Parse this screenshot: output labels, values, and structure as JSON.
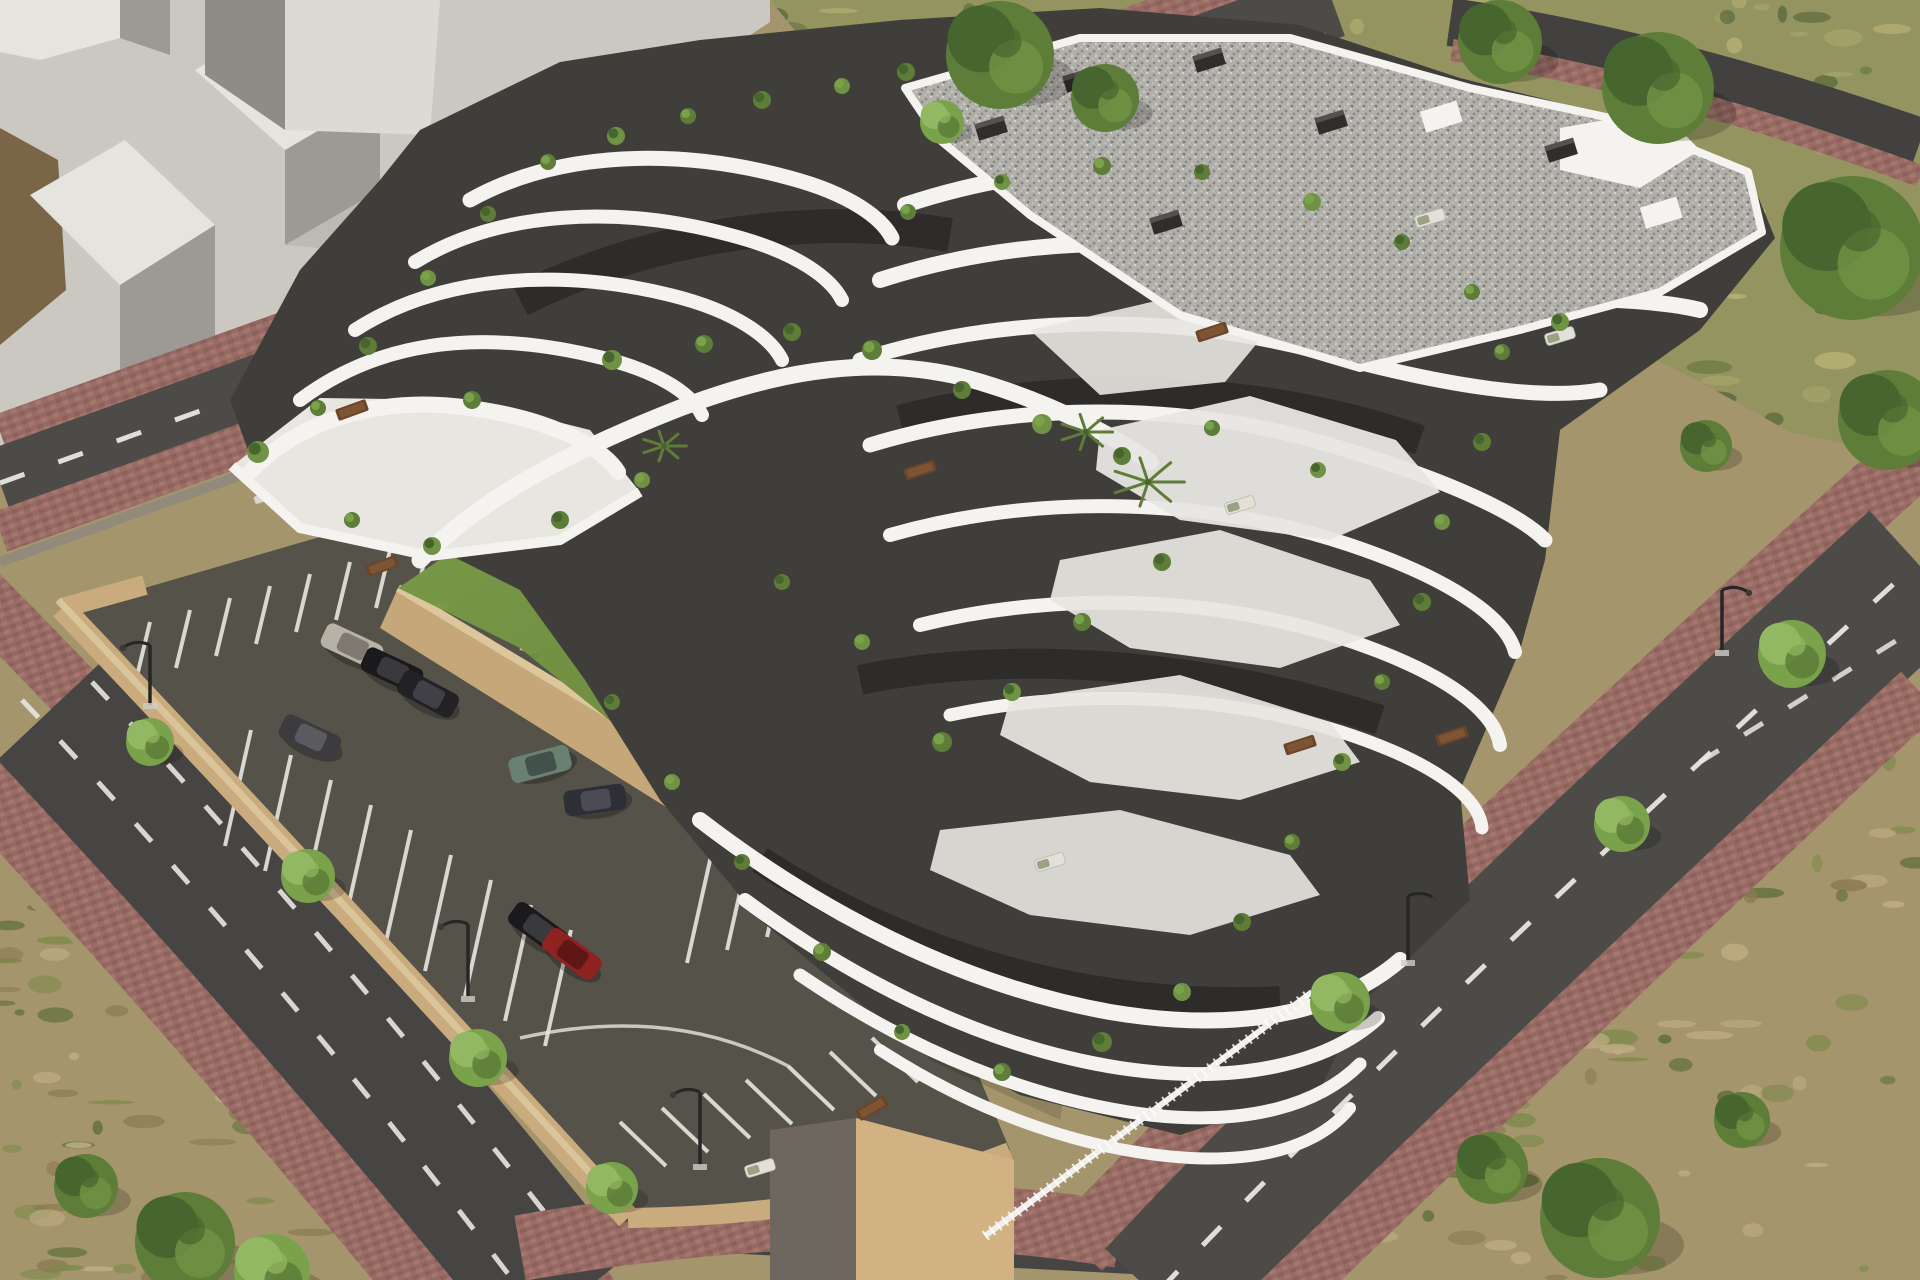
{
  "scene": {
    "kind": "architectural-aerial-render",
    "width": 1920,
    "height": 1280,
    "subject": "terraced-apartment-complex-with-pool-courtyard-parking-and-ring-roads"
  },
  "palette": {
    "massing-base": "#cbc8c2",
    "massing-light": "#e6e4df",
    "massing-top": "#dcdad5",
    "massing-dark": "#9d9a95",
    "massing-shadow": "#b2afaa",
    "ground-brown": "#7a6647",
    "drygrass": "#949461",
    "drygrass-l1": "#b7b173",
    "drygrass-l2": "#a3a368",
    "drygrass-d1": "#66763f",
    "drygrass-d2": "#55653a",
    "scrub": "#a5956d",
    "scrub-g1": "#5c6e38",
    "scrub-g2": "#7b8a49",
    "scrub-l1": "#c0ae85",
    "road": "#4c4b48",
    "road-dark": "#424140",
    "brick": "#996d66",
    "brick-a": "#8d605a",
    "brick-b": "#a5776f",
    "brick-c": "#936760",
    "curb": "#8a8782",
    "parking-asphalt": "#555249",
    "parking-dark": "#494640",
    "wall-top": "#dcc79c",
    "wall-face": "#c5a77a",
    "wall-dark": "#a8895f",
    "lawn": "#6e8e3e",
    "lawn-light": "#7d9c49",
    "lawn-dark": "#5e7b34",
    "pool-light": "#d3ece7",
    "pool-deep": "#9fd6cc",
    "coping": "#f7f6f3",
    "deck": "#8d887a",
    "deck-dark": "#5f5c51",
    "bldg-white": "#f4f3ef",
    "bldg-terrace": "#e8e6e1",
    "bldg-shade": "#d8d6d0",
    "bldg-dark": "#403e3a",
    "bldg-glass": "#2d2c2a",
    "bldg-mid": "#6e6b65",
    "plinth": "#d2b283",
    "gravel": "#b0afaa",
    "gravel-d": "#84837e",
    "gravel-l": "#d6d5d1",
    "green-bright": "#7aa24b",
    "green-mid": "#5d7d38",
    "green-dark": "#47662f",
    "green-light": "#93b863",
    "umbrella-tan": "#d2bb97",
    "umbrella-white": "#efedec",
    "lamp": "#262625",
    "stripe-white": "#e8e6e0",
    "playground-blue": "#3f5fc0",
    "playground-red": "#b04a3e",
    "playground-green": "#4a7b44",
    "table-brown": "#6b452a"
  },
  "parking": {
    "stripe_rows": [
      {
        "x": 150,
        "y": 622,
        "dx": 40,
        "dy": -12,
        "n": 12,
        "ex": -14,
        "ey": 58,
        "note": "row-under-top-road"
      },
      {
        "x": 238,
        "y": 788,
        "dx": 40,
        "dy": 25,
        "n": 9,
        "ex": 13,
        "ey": -58,
        "note": "middle-row-upper-side"
      },
      {
        "x": 238,
        "y": 788,
        "dx": 40,
        "dy": 25,
        "n": 9,
        "ex": -13,
        "ey": 58,
        "note": "middle-row-lower-side"
      },
      {
        "x": 700,
        "y": 905,
        "dx": 40,
        "dy": -13,
        "n": 8,
        "ex": 13,
        "ey": -58,
        "note": "east-row-upper-side"
      },
      {
        "x": 700,
        "y": 905,
        "dx": 40,
        "dy": -13,
        "n": 8,
        "ex": -13,
        "ey": 58,
        "note": "east-row-lower-side"
      },
      {
        "x": 620,
        "y": 1122,
        "dx": 42,
        "dy": -14,
        "n": 10,
        "ex": 46,
        "ey": 44,
        "note": "row-along-south-road"
      }
    ],
    "guide_arcs": [
      "M520,648 q66,18 78,96",
      "M560,700 q52,16 62,78",
      "M520,1038 q150,-34 268,28"
    ],
    "cars": [
      {
        "x": 352,
        "y": 646,
        "rot": 25,
        "body": "#b7b2a6",
        "glass": "#7e7a72",
        "name": "silver-car"
      },
      {
        "x": 392,
        "y": 670,
        "rot": 25,
        "body": "#1a1a1d",
        "glass": "#3a3a3e",
        "name": "black-car"
      },
      {
        "x": 428,
        "y": 694,
        "rot": 28,
        "body": "#222226",
        "glass": "#404046",
        "name": "black-car"
      },
      {
        "x": 310,
        "y": 737,
        "rot": 25,
        "body": "#3c3c40",
        "glass": "#5a5a60",
        "name": "gray-car"
      },
      {
        "x": 540,
        "y": 764,
        "rot": -15,
        "body": "#6a8071",
        "glass": "#42514a",
        "name": "green-suv"
      },
      {
        "x": 595,
        "y": 800,
        "rot": -8,
        "body": "#2e2e35",
        "glass": "#4b4b55",
        "name": "dark-sedan"
      },
      {
        "x": 538,
        "y": 928,
        "rot": 36,
        "body": "#1a1a1d",
        "glass": "#3a3a3e",
        "name": "black-car"
      },
      {
        "x": 572,
        "y": 954,
        "rot": 36,
        "body": "#8f2321",
        "glass": "#5e1715",
        "name": "red-car"
      }
    ]
  },
  "street": {
    "lamps": [
      {
        "x": 468,
        "y": 998,
        "h": 74,
        "dir": -1
      },
      {
        "x": 700,
        "y": 1166,
        "h": 74,
        "dir": -1
      },
      {
        "x": 1408,
        "y": 962,
        "h": 66,
        "dir": 1
      },
      {
        "x": 1722,
        "y": 652,
        "h": 62,
        "dir": 1
      },
      {
        "x": 150,
        "y": 705,
        "h": 60,
        "dir": -1
      }
    ]
  },
  "vegetation": {
    "trees": [
      {
        "x": 150,
        "y": 742,
        "r": 24,
        "t": "bright"
      },
      {
        "x": 308,
        "y": 876,
        "r": 27,
        "t": "bright"
      },
      {
        "x": 478,
        "y": 1058,
        "r": 29,
        "t": "bright"
      },
      {
        "x": 612,
        "y": 1188,
        "r": 26,
        "t": "bright"
      },
      {
        "x": 1340,
        "y": 1002,
        "r": 30,
        "t": "bright"
      },
      {
        "x": 1622,
        "y": 824,
        "r": 28,
        "t": "bright"
      },
      {
        "x": 1792,
        "y": 654,
        "r": 34,
        "t": "bright"
      },
      {
        "x": 1000,
        "y": 55,
        "r": 54,
        "t": "dark"
      },
      {
        "x": 1105,
        "y": 98,
        "r": 34,
        "t": "dark"
      },
      {
        "x": 942,
        "y": 122,
        "r": 22,
        "t": "bright"
      },
      {
        "x": 1500,
        "y": 42,
        "r": 42,
        "t": "dark"
      },
      {
        "x": 1658,
        "y": 88,
        "r": 56,
        "t": "dark"
      },
      {
        "x": 1852,
        "y": 248,
        "r": 72,
        "t": "dark"
      },
      {
        "x": 1888,
        "y": 420,
        "r": 50,
        "t": "dark"
      },
      {
        "x": 1706,
        "y": 446,
        "r": 26,
        "t": "dark"
      },
      {
        "x": 185,
        "y": 1242,
        "r": 50,
        "t": "dark"
      },
      {
        "x": 86,
        "y": 1186,
        "r": 32,
        "t": "dark"
      },
      {
        "x": 272,
        "y": 1272,
        "r": 38,
        "t": "bright"
      },
      {
        "x": 1600,
        "y": 1218,
        "r": 60,
        "t": "dark"
      },
      {
        "x": 1492,
        "y": 1168,
        "r": 36,
        "t": "dark"
      },
      {
        "x": 1742,
        "y": 1120,
        "r": 28,
        "t": "dark"
      }
    ],
    "palms": [
      {
        "x": 1148,
        "y": 482,
        "r": 26
      },
      {
        "x": 1086,
        "y": 432,
        "r": 19
      },
      {
        "x": 664,
        "y": 446,
        "r": 16
      }
    ],
    "terrace_plants": [
      {
        "x": 258,
        "y": 452,
        "r": 11
      },
      {
        "x": 318,
        "y": 408,
        "r": 8
      },
      {
        "x": 368,
        "y": 346,
        "r": 9
      },
      {
        "x": 428,
        "y": 278,
        "r": 8
      },
      {
        "x": 488,
        "y": 214,
        "r": 8
      },
      {
        "x": 548,
        "y": 162,
        "r": 8
      },
      {
        "x": 616,
        "y": 136,
        "r": 9
      },
      {
        "x": 688,
        "y": 116,
        "r": 8
      },
      {
        "x": 762,
        "y": 100,
        "r": 9
      },
      {
        "x": 842,
        "y": 86,
        "r": 8
      },
      {
        "x": 906,
        "y": 72,
        "r": 9
      },
      {
        "x": 472,
        "y": 400,
        "r": 9
      },
      {
        "x": 612,
        "y": 360,
        "r": 10
      },
      {
        "x": 704,
        "y": 344,
        "r": 9
      },
      {
        "x": 792,
        "y": 332,
        "r": 9
      },
      {
        "x": 642,
        "y": 480,
        "r": 8
      },
      {
        "x": 560,
        "y": 520,
        "r": 9
      },
      {
        "x": 352,
        "y": 520,
        "r": 8
      },
      {
        "x": 432,
        "y": 546,
        "r": 9
      },
      {
        "x": 872,
        "y": 350,
        "r": 10
      },
      {
        "x": 962,
        "y": 390,
        "r": 9
      },
      {
        "x": 1042,
        "y": 424,
        "r": 10
      },
      {
        "x": 1122,
        "y": 456,
        "r": 9
      },
      {
        "x": 908,
        "y": 212,
        "r": 8
      },
      {
        "x": 1002,
        "y": 182,
        "r": 8
      },
      {
        "x": 1102,
        "y": 166,
        "r": 9
      },
      {
        "x": 1202,
        "y": 172,
        "r": 8
      },
      {
        "x": 1312,
        "y": 202,
        "r": 9
      },
      {
        "x": 1402,
        "y": 242,
        "r": 8
      },
      {
        "x": 1472,
        "y": 292,
        "r": 8
      },
      {
        "x": 1560,
        "y": 322,
        "r": 9
      },
      {
        "x": 1502,
        "y": 352,
        "r": 8
      },
      {
        "x": 1482,
        "y": 442,
        "r": 9
      },
      {
        "x": 1442,
        "y": 522,
        "r": 8
      },
      {
        "x": 1422,
        "y": 602,
        "r": 9
      },
      {
        "x": 1382,
        "y": 682,
        "r": 8
      },
      {
        "x": 1342,
        "y": 762,
        "r": 9
      },
      {
        "x": 1292,
        "y": 842,
        "r": 8
      },
      {
        "x": 1242,
        "y": 922,
        "r": 9
      },
      {
        "x": 1182,
        "y": 992,
        "r": 9
      },
      {
        "x": 1102,
        "y": 1042,
        "r": 10
      },
      {
        "x": 1002,
        "y": 1072,
        "r": 9
      },
      {
        "x": 902,
        "y": 1032,
        "r": 8
      },
      {
        "x": 822,
        "y": 952,
        "r": 9
      },
      {
        "x": 742,
        "y": 862,
        "r": 8
      },
      {
        "x": 672,
        "y": 782,
        "r": 8
      },
      {
        "x": 612,
        "y": 702,
        "r": 8
      },
      {
        "x": 942,
        "y": 742,
        "r": 10
      },
      {
        "x": 1012,
        "y": 692,
        "r": 9
      },
      {
        "x": 1082,
        "y": 622,
        "r": 9
      },
      {
        "x": 1162,
        "y": 562,
        "r": 9
      },
      {
        "x": 862,
        "y": 642,
        "r": 8
      },
      {
        "x": 782,
        "y": 582,
        "r": 8
      },
      {
        "x": 1212,
        "y": 428,
        "r": 8
      },
      {
        "x": 1318,
        "y": 470,
        "r": 8
      }
    ]
  },
  "courtyard": {
    "parasols": [
      {
        "x": 700,
        "y": 470,
        "r": 27
      },
      {
        "x": 762,
        "y": 482,
        "r": 26
      },
      {
        "x": 826,
        "y": 496,
        "r": 26
      },
      {
        "x": 898,
        "y": 518,
        "r": 27
      }
    ],
    "closed_umbrellas": [
      {
        "x": 745,
        "y": 500
      },
      {
        "x": 810,
        "y": 515
      },
      {
        "x": 868,
        "y": 530
      },
      {
        "x": 930,
        "y": 556
      },
      {
        "x": 958,
        "y": 572
      }
    ],
    "lounger_rows": [
      {
        "x": 642,
        "y": 487,
        "dx": 30,
        "dy": 8.6,
        "n": 13,
        "rot": 25,
        "w": 17,
        "h": 8
      },
      {
        "x": 262,
        "y": 498,
        "dx": 27,
        "dy": -8,
        "n": 5,
        "rot": -20,
        "w": 16,
        "h": 8
      },
      {
        "x": 470,
        "y": 513,
        "dx": 27,
        "dy": -8,
        "n": 4,
        "rot": -20,
        "w": 16,
        "h": 8
      },
      {
        "x": 530,
        "y": 300,
        "dx": 25,
        "dy": -7,
        "n": 4,
        "rot": -20,
        "w": 15,
        "h": 7
      },
      {
        "x": 1278,
        "y": 508,
        "dx": 26,
        "dy": -7,
        "n": 3,
        "rot": -18,
        "w": 16,
        "h": 8
      },
      {
        "x": 1052,
        "y": 150,
        "dx": 25,
        "dy": -7,
        "n": 4,
        "rot": -18,
        "w": 15,
        "h": 7
      }
    ],
    "playground": {
      "x": 938,
      "y": 440,
      "w": 60,
      "h": 80
    }
  },
  "building": {
    "chimneys": [
      {
        "x": 1078,
        "y": 80
      },
      {
        "x": 1208,
        "y": 60
      },
      {
        "x": 1330,
        "y": 122
      },
      {
        "x": 1560,
        "y": 150
      },
      {
        "x": 1165,
        "y": 222
      },
      {
        "x": 990,
        "y": 128
      }
    ],
    "roof_boxes": [
      {
        "x": 1440,
        "y": 116
      },
      {
        "x": 1660,
        "y": 212
      }
    ],
    "tables": [
      {
        "x": 382,
        "y": 566,
        "rot": -20
      },
      {
        "x": 352,
        "y": 410,
        "rot": -20
      },
      {
        "x": 920,
        "y": 470,
        "rot": -18
      },
      {
        "x": 1300,
        "y": 745,
        "rot": -18
      },
      {
        "x": 1212,
        "y": 332,
        "rot": -18
      },
      {
        "x": 872,
        "y": 1108,
        "rot": -30
      },
      {
        "x": 1452,
        "y": 736,
        "rot": -18
      }
    ],
    "sofas": [
      {
        "x": 1240,
        "y": 505
      },
      {
        "x": 1430,
        "y": 218
      },
      {
        "x": 1050,
        "y": 862
      },
      {
        "x": 760,
        "y": 1168
      },
      {
        "x": 1560,
        "y": 336
      }
    ]
  },
  "mottle_regions": [
    {
      "clip": "clip-topgrass",
      "bbox": [
        770,
        0,
        1150,
        460
      ],
      "count": 150,
      "seed": 7,
      "colors": [
        "#b7b173",
        "#a3a368",
        "#66763f",
        "#55653a"
      ]
    },
    {
      "clip": "clip-scrub-br",
      "bbox": [
        1230,
        640,
        690,
        640
      ],
      "count": 130,
      "seed": 11,
      "colors": [
        "#c0ae85",
        "#5c6e38",
        "#7b8a49",
        "#8a7a52"
      ]
    },
    {
      "clip": "clip-scrub-bl",
      "bbox": [
        0,
        880,
        470,
        400
      ],
      "count": 80,
      "seed": 23,
      "colors": [
        "#c0ae85",
        "#5c6e38",
        "#7b8a49",
        "#8a7a52"
      ]
    },
    {
      "clip": "clip-lawn",
      "bbox": [
        395,
        320,
        760,
        570
      ],
      "count": 110,
      "seed": 31,
      "colors": [
        "#5e7b34",
        "#7d9c49",
        "#648539",
        "#567530"
      ]
    }
  ]
}
